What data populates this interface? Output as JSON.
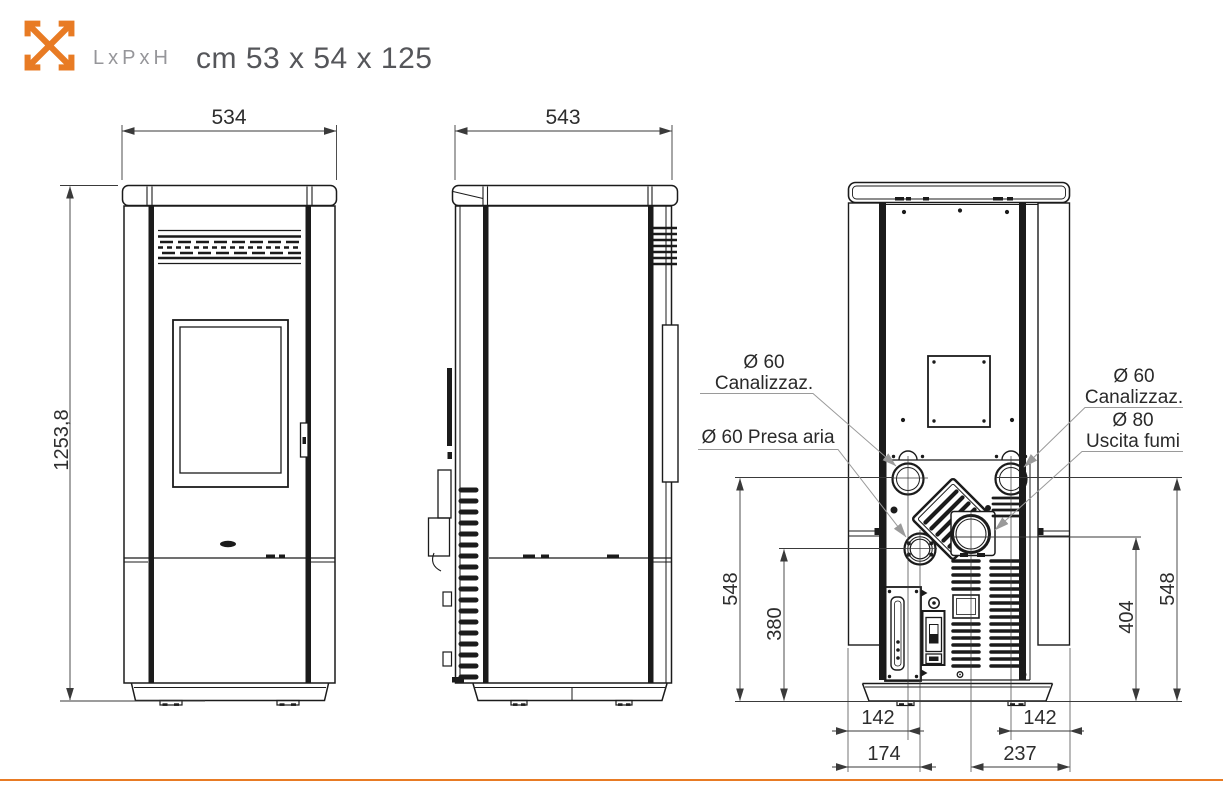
{
  "header": {
    "icon": "resize-arrows",
    "label": "LxPxH",
    "value": "cm 53 x 54 x 125"
  },
  "colors": {
    "accent": "#e87b24",
    "line": "#1b1b1b",
    "dimension_text": "#2d2d2d",
    "leader": "#9a9a9a"
  },
  "front_view": {
    "width_mm": "534",
    "height_mm": "1253,8"
  },
  "side_view": {
    "depth_mm": "543"
  },
  "back_view": {
    "callouts": {
      "canalizzazione_left_diameter": "Ø 60",
      "canalizzazione_left_name": "Canalizzaz.",
      "presa_aria": "Ø 60 Presa aria",
      "canalizzazione_right_diameter": "Ø 60",
      "canalizzazione_right_name": "Canalizzaz.",
      "uscita_fumi_diameter": "Ø 80",
      "uscita_fumi_name": "Uscita fumi"
    },
    "dimensions": {
      "canalizzazione_height": "548",
      "presa_aria_height": "380",
      "uscita_fumi_height": "404",
      "canalizzazione_height_right": "548",
      "canalizzazione_left_offset": "142",
      "presa_aria_offset": "174",
      "canalizzazione_right_offset": "142",
      "uscita_fumi_offset": "237"
    }
  }
}
